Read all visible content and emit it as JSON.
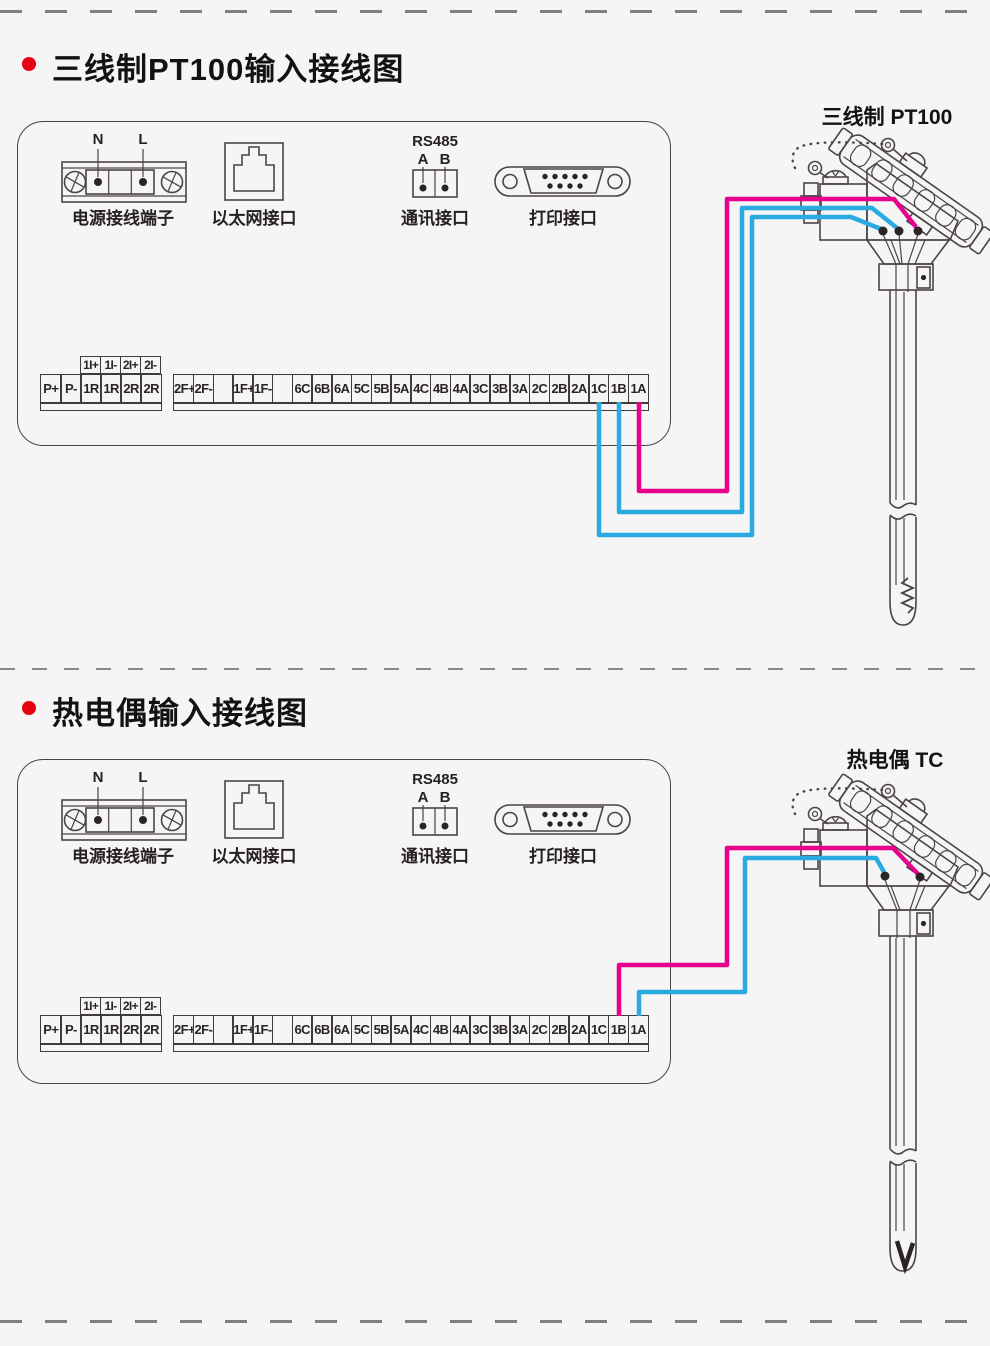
{
  "colors": {
    "accent_red": "#e60012",
    "line": "#4c4347",
    "wire_pink": "#e6008c",
    "wire_blue": "#29abe2",
    "terminal_dot": "#2a2426"
  },
  "sections": [
    {
      "title": "三线制PT100输入接线图",
      "sensor_label": "三线制 PT100",
      "panel": {
        "power_n": "N",
        "power_l": "L",
        "power_label": "电源接线端子",
        "ethernet_label": "以太网接口",
        "rs485_title": "RS485",
        "rs485_a": "A",
        "rs485_b": "B",
        "comm_label": "通讯接口",
        "print_label": "打印接口"
      },
      "wiring": {
        "sensor_type": "PT100 three-wire",
        "wires": [
          {
            "terminal": "1C",
            "color": "blue"
          },
          {
            "terminal": "1B",
            "color": "blue"
          },
          {
            "terminal": "1A",
            "color": "pink"
          }
        ]
      }
    },
    {
      "title": "热电偶输入接线图",
      "sensor_label": "热电偶 TC",
      "panel": {
        "power_n": "N",
        "power_l": "L",
        "power_label": "电源接线端子",
        "ethernet_label": "以太网接口",
        "rs485_title": "RS485",
        "rs485_a": "A",
        "rs485_b": "B",
        "comm_label": "通讯接口",
        "print_label": "打印接口"
      },
      "wiring": {
        "sensor_type": "thermocouple",
        "wires": [
          {
            "terminal": "1B",
            "color": "pink"
          },
          {
            "terminal": "1A",
            "color": "blue"
          }
        ]
      }
    }
  ],
  "terminal_strip": {
    "aux_row": [
      "1I+",
      "1I-",
      "2I+",
      "2I-"
    ],
    "left_block": [
      "P+",
      "P-",
      "1R",
      "1R",
      "2R",
      "2R"
    ],
    "right_block": [
      "2F+",
      "2F-",
      "",
      "1F+",
      "1F-",
      "",
      "6C",
      "6B",
      "6A",
      "5C",
      "5B",
      "5A",
      "4C",
      "4B",
      "4A",
      "3C",
      "3B",
      "3A",
      "2C",
      "2B",
      "2A",
      "1C",
      "1B",
      "1A"
    ]
  }
}
